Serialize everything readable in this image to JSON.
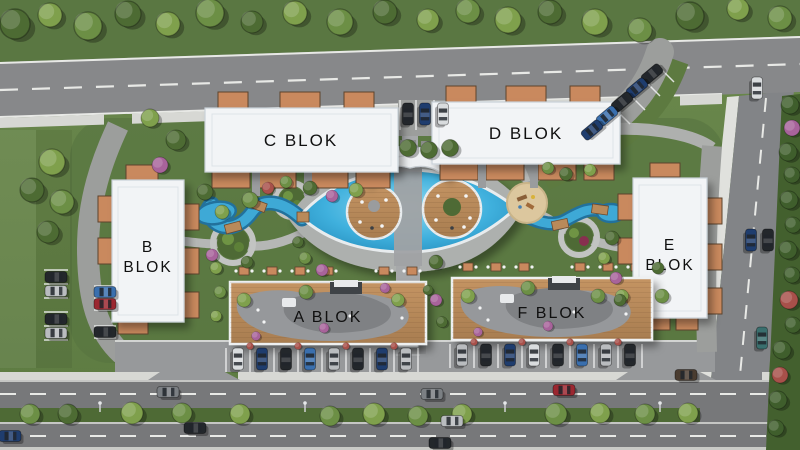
{
  "blocks": {
    "a": {
      "label": "A BLOK"
    },
    "b": {
      "label": "B BLOK",
      "line1": "B",
      "line2": "BLOK"
    },
    "c": {
      "label": "C BLOK"
    },
    "d": {
      "label": "D BLOK"
    },
    "e": {
      "label": "E BLOK",
      "line1": "E",
      "line2": "BLOK"
    },
    "f": {
      "label": "F BLOK"
    }
  },
  "palette": {
    "grass": "#67854a",
    "grass_dark": "#587540",
    "asphalt": "#85868a",
    "asphalt_dark": "#76777b",
    "sidewalk": "#d7d8d4",
    "internal_road": "#9c9e9c",
    "path_gray": "#b5b7b5",
    "building_white": "#f2f4f6",
    "balcony_wood": "#c9895e",
    "deck_wood": "#bb8c5c",
    "pool_blue": "#3fb0dd",
    "pool_deep": "#1f85b5",
    "sand": "#dcc79e",
    "median_green": "#4e6a35",
    "hedge_green": "#43602e",
    "tree_colors": {
      "d": "#4d6b33",
      "l": "#7fa04c",
      "o": "#6c8f45",
      "g": "#3f5e2c",
      "p": "#a8639b",
      "r": "#a8504a"
    },
    "car_colors": {
      "k": "#23272b",
      "n": "#1f3d6e",
      "b": "#3a6fae",
      "r": "#9b2730",
      "w": "#d9dcde",
      "s": "#b9bcbf",
      "g": "#7b7f83",
      "t": "#3a6f6e",
      "v": "#4a3c30"
    }
  }
}
